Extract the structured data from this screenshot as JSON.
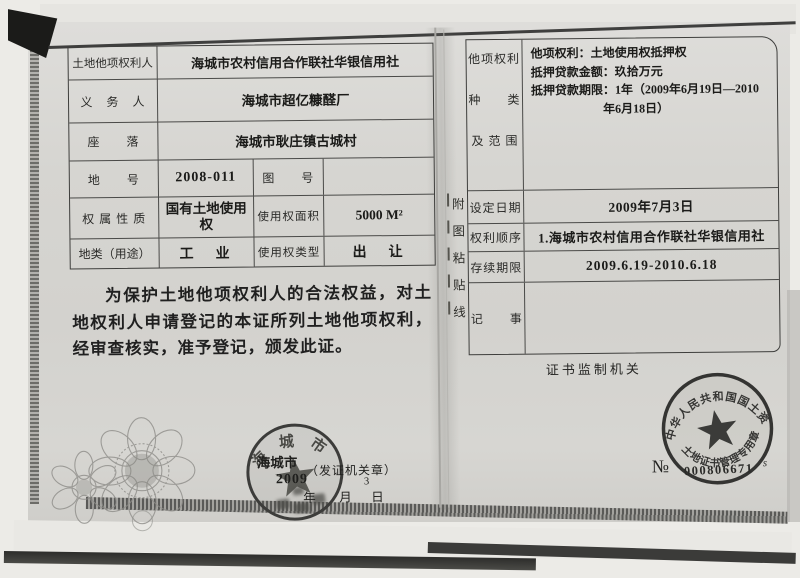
{
  "colors": {
    "paper": "#d6d5d1",
    "ink": "#1d1d1b",
    "seal_ink": "#3b3b39"
  },
  "left_page": {
    "rows": [
      {
        "label": "土地他项权利人",
        "value": "海城市农村信用合作联社华银信用社"
      },
      {
        "label": "义　务　人",
        "value": "海城市超亿糠醛厂"
      },
      {
        "label": "座　　落",
        "value": "海城市耿庄镇古城村"
      },
      {
        "label": "地　　号",
        "value": "2008-011",
        "label2": "图　　号",
        "value2": ""
      },
      {
        "label": "权 属 性 质",
        "value": "国有土地使用权",
        "label2": "使用权面积",
        "value2": "5000 M²"
      },
      {
        "label": "地类（用途）",
        "value": "工　业",
        "label2": "使用权类型",
        "value2": "出　让"
      }
    ],
    "statement": "为保护土地他项权利人的合法权益，对土地权利人申请登记的本证所列土地他项权利，经审查核实，准予登记，颁发此证。"
  },
  "right_page": {
    "rights_label_lines": [
      "他项权利",
      "种　　类",
      "及 范 围"
    ],
    "rights_content": "他项权利：土地使用权抵押权\n抵押贷款金额：玖拾万元\n抵押贷款期限：1年（2009年6月19日—2010\n　　　　　　年6月18日）",
    "rows": [
      {
        "label": "设定日期",
        "value": "2009年7月3日"
      },
      {
        "label": "权利顺序",
        "value": "1.海城市农村信用合作联社华银信用社"
      },
      {
        "label": "存续期限",
        "value": "2009.6.19-2010.6.18"
      },
      {
        "label": "记　　事",
        "value": ""
      }
    ],
    "attachment_chars": [
      "附",
      "图",
      "粘",
      "贴",
      "线"
    ],
    "footer_label": "证书监制机关"
  },
  "issuer_seal": {
    "arc_text": "海城市",
    "overlay_city": "海城市",
    "overlay_label": "（发证机关章）",
    "year": "2009",
    "year_char": "年",
    "month_char": "月",
    "day_char": "日",
    "day_number": "3"
  },
  "ministry_seal": {
    "arc_top": "中华人民共和国国土资源部",
    "arc_bottom": "土地证书管理专用章",
    "serial_prefix": "№",
    "serial_number": "000806671",
    "serial_mark": "s"
  }
}
